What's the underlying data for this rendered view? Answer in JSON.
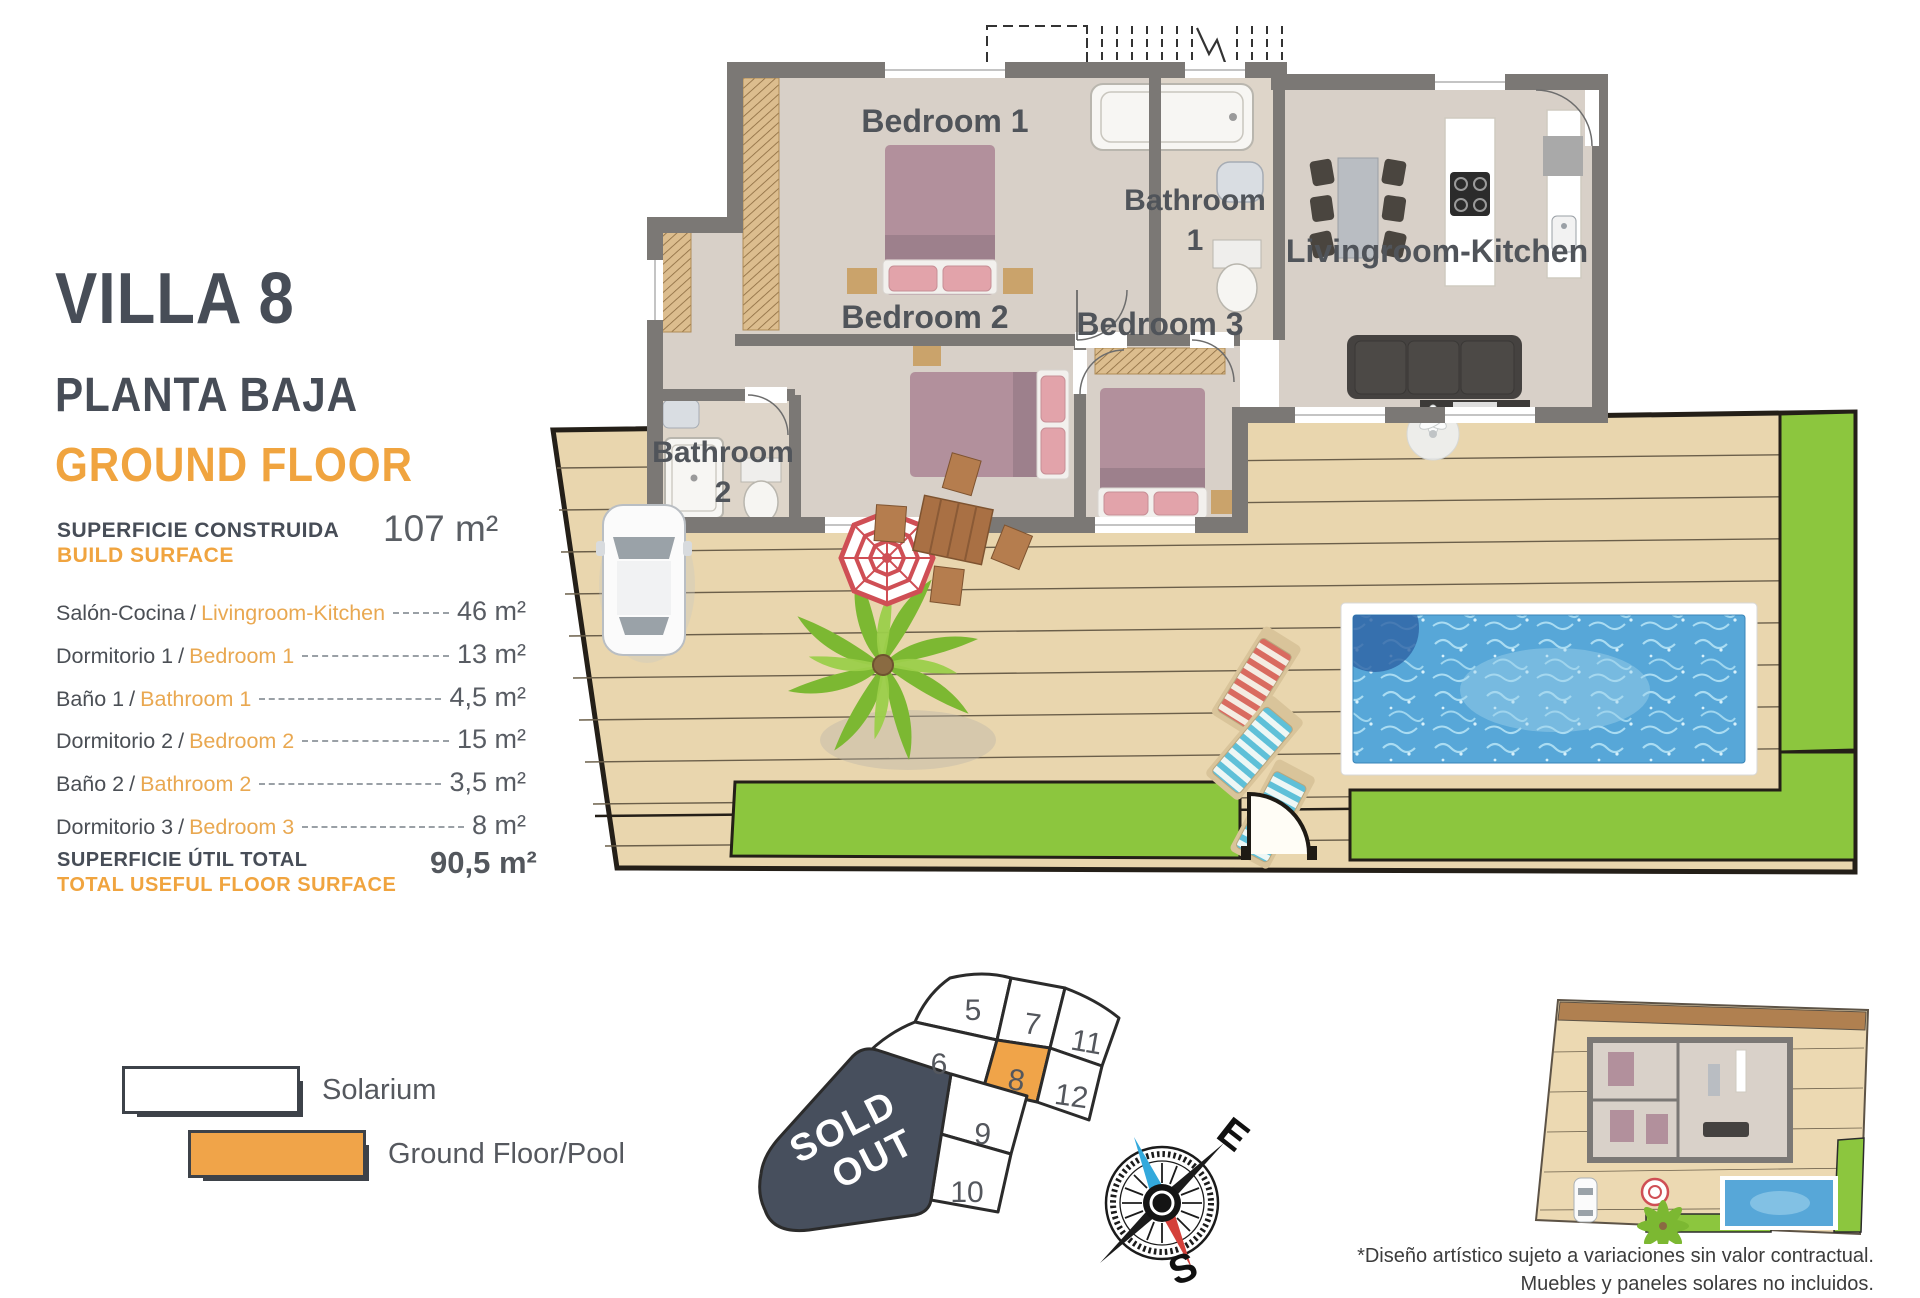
{
  "panel": {
    "title": "VILLA 8",
    "subtitle_es": "PLANTA BAJA",
    "subtitle_en": "GROUND FLOOR",
    "separator": "/",
    "build_surface": {
      "label_es": "SUPERFICIE CONSTRUIDA",
      "label_en": "BUILD SURFACE",
      "value": "107 m²"
    },
    "rooms": [
      {
        "label_es": "Salón-Cocina",
        "label_en": "Livingroom-Kitchen",
        "value": "46 m²"
      },
      {
        "label_es": "Dormitorio 1",
        "label_en": "Bedroom 1",
        "value": "13 m²"
      },
      {
        "label_es": "Baño 1",
        "label_en": "Bathroom 1",
        "value": "4,5 m²"
      },
      {
        "label_es": "Dormitorio 2",
        "label_en": "Bedroom 2",
        "value": "15 m²"
      },
      {
        "label_es": "Baño 2",
        "label_en": "Bathroom 2",
        "value": "3,5 m²"
      },
      {
        "label_es": "Dormitorio 3",
        "label_en": "Bedroom 3",
        "value": "8 m²"
      }
    ],
    "total": {
      "label_es": "SUPERFICIE ÚTIL TOTAL",
      "label_en": "TOTAL USEFUL FLOOR SURFACE",
      "value": "90,5 m²"
    }
  },
  "legend": {
    "items": [
      {
        "label": "Solarium",
        "fill": "#ffffff"
      },
      {
        "label": "Ground Floor/Pool",
        "fill": "#f0a449"
      }
    ]
  },
  "floorplan": {
    "labels": {
      "bedroom1": "Bedroom 1",
      "bathroom1_l1": "Bathroom",
      "bathroom1_l2": "1",
      "bedroom2": "Bedroom 2",
      "bedroom3": "Bedroom 3",
      "bathroom2_l1": "Bathroom",
      "bathroom2_l2": "2",
      "living": "Livingroom-Kitchen"
    }
  },
  "plot_map": {
    "sold_line1": "SOLD",
    "sold_line2": "OUT",
    "highlighted_plot": "8",
    "plots": {
      "p5": "5",
      "p6": "6",
      "p7": "7",
      "p8": "8",
      "p9": "9",
      "p10": "10",
      "p11": "11",
      "p12": "12"
    }
  },
  "compass": {
    "east": "E",
    "south": "S"
  },
  "disclaimer": {
    "line1": "*Diseño artístico sujeto a variaciones sin valor contractual.",
    "line2": "Muebles y paneles solares no incluidos."
  },
  "colors": {
    "accent_orange": "#f0a43f",
    "title_gray": "#474d57",
    "plot_highlight": "#f0a449",
    "pool_blue": "#57a7d8",
    "grass_green": "#8cc63e",
    "sold_out_bg": "#474f5d",
    "deck_tan": "#e9d6ae",
    "wall_gray": "#7b7875"
  }
}
